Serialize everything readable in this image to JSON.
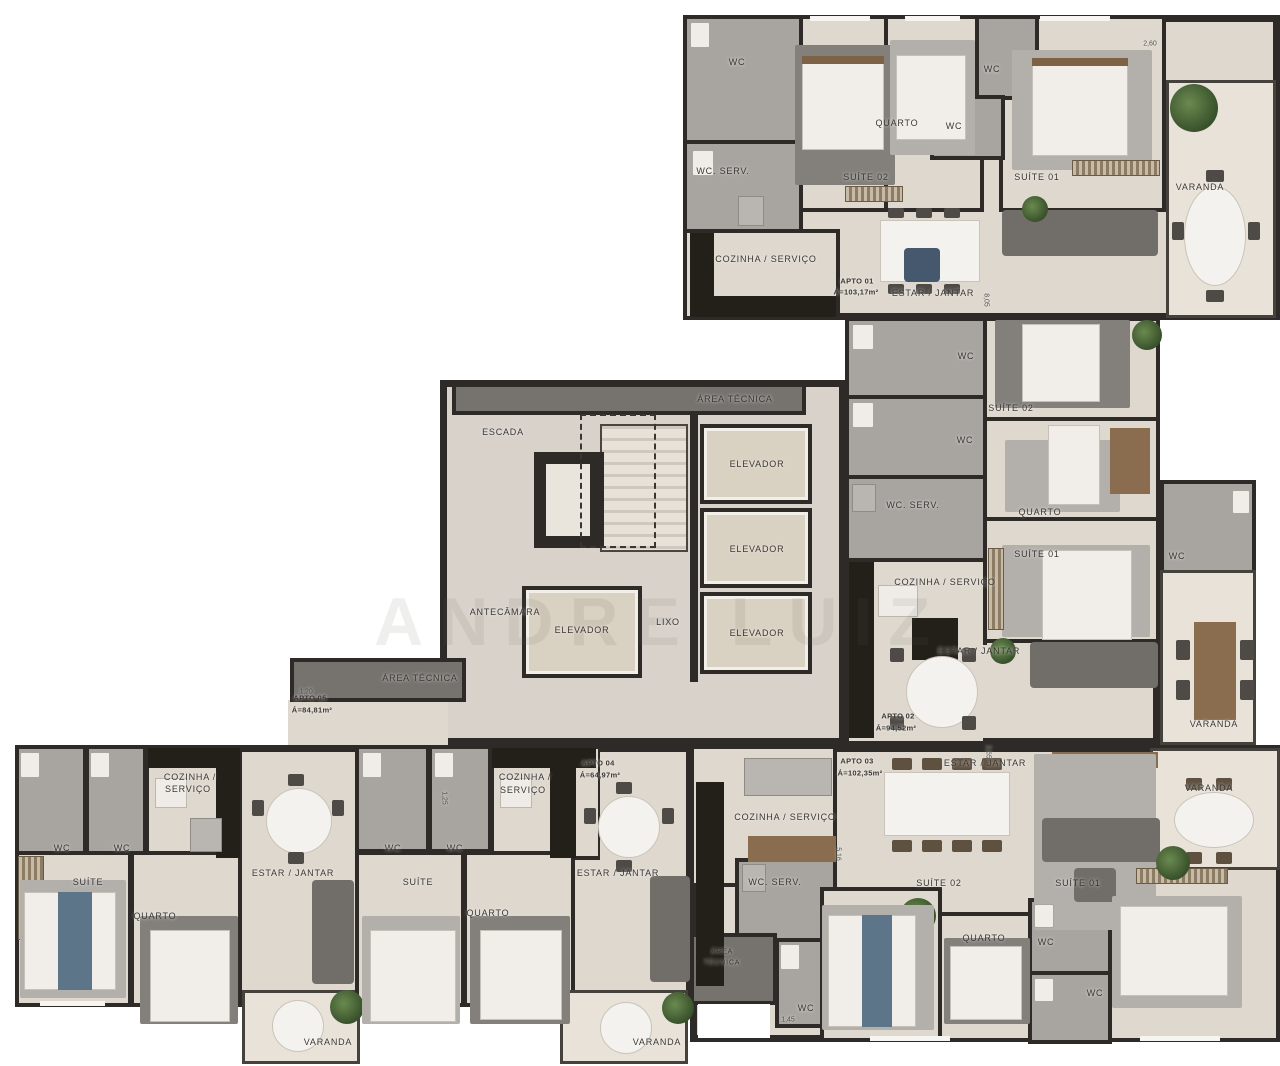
{
  "watermark": "ANDRE LUIZ",
  "colors": {
    "wall": "#2e2a27",
    "floor": "#ded8cf",
    "bathroom": "#a8a5a1",
    "core_floor": "#d8d2cb",
    "elevator": "#d9d1c1",
    "balcony": "#e8e2d9",
    "tech_area": "#76736f",
    "label_text": "#3b3733"
  },
  "apartments": [
    {
      "name": "APTO 01",
      "area_label": "Á=103,17m²",
      "rooms": [
        "SUÍTE 01",
        "SUÍTE 02",
        "QUARTO",
        "ESTAR / JANTAR",
        "COZINHA / SERVIÇO",
        "WC",
        "WC",
        "WC",
        "WC. SERV.",
        "VARANDA"
      ]
    },
    {
      "name": "APTO 02",
      "area_label": "Á=94,52m²",
      "rooms": [
        "SUÍTE 01",
        "SUÍTE 02",
        "QUARTO",
        "ESTAR / JANTAR",
        "COZINHA / SERVIÇO",
        "WC",
        "WC",
        "WC",
        "WC. SERV.",
        "VARANDA"
      ]
    },
    {
      "name": "APTO 03",
      "area_label": "Á=102,35m²",
      "rooms": [
        "SUÍTE 01",
        "SUÍTE 02",
        "QUARTO",
        "ESTAR / JANTAR",
        "COZINHA / SERVIÇO",
        "WC",
        "WC",
        "WC",
        "WC. SERV.",
        "ÁREA TÉCNICA",
        "VARANDA"
      ]
    },
    {
      "name": "APTO 04",
      "area_label": "Á=64,97m²",
      "rooms": [
        "SUÍTE",
        "QUARTO",
        "ESTAR / JANTAR",
        "COZINHA / SERVIÇO",
        "WC",
        "WC",
        "VARANDA"
      ]
    },
    {
      "name": "APTO 05",
      "area_label": "Á=84,81m²",
      "rooms": [
        "SUÍTE",
        "QUARTO",
        "ESTAR / JANTAR",
        "COZINHA / SERVIÇO",
        "WC",
        "WC",
        "VARANDA"
      ]
    }
  ],
  "common_areas": [
    "ESCADA",
    "ANTECÂMARA",
    "LIXO",
    "ELEVADOR",
    "ELEVADOR",
    "ELEVADOR",
    "ELEVADOR",
    "ÁREA TÉCNICA",
    "ÁREA TÉCNICA",
    "ÁREA TÉCNICA"
  ],
  "labels": [
    {
      "n": "label-wc",
      "t": "WC",
      "x": 737,
      "y": 62
    },
    {
      "n": "label-quarto",
      "t": "QUARTO",
      "x": 897,
      "y": 123
    },
    {
      "n": "label-wc",
      "t": "WC",
      "x": 992,
      "y": 69
    },
    {
      "n": "label-wc",
      "t": "WC",
      "x": 954,
      "y": 126
    },
    {
      "n": "label-wc-serv",
      "t": "WC. SERV.",
      "x": 723,
      "y": 171
    },
    {
      "n": "label-suite-02",
      "t": "SUÍTE 02",
      "x": 866,
      "y": 177
    },
    {
      "n": "label-suite-01",
      "t": "SUÍTE 01",
      "x": 1037,
      "y": 177
    },
    {
      "n": "label-varanda",
      "t": "VARANDA",
      "x": 1200,
      "y": 187
    },
    {
      "n": "label-cozinha-servico",
      "t": "COZINHA / SERVIÇO",
      "x": 766,
      "y": 259
    },
    {
      "n": "label-apto-01",
      "t": "APTO 01",
      "x": 857,
      "y": 281,
      "b": 1
    },
    {
      "n": "label-apto-01-area",
      "t": "Á=103,17m²",
      "x": 856,
      "y": 292,
      "b": 1
    },
    {
      "n": "label-estar-jantar",
      "t": "ESTAR / JANTAR",
      "x": 933,
      "y": 293
    },
    {
      "n": "label-area-tecnica",
      "t": "ÁREA TÉCNICA",
      "x": 735,
      "y": 399
    },
    {
      "n": "label-escada",
      "t": "ESCADA",
      "x": 503,
      "y": 432
    },
    {
      "n": "label-elevador",
      "t": "ELEVADOR",
      "x": 757,
      "y": 464
    },
    {
      "n": "label-elevador",
      "t": "ELEVADOR",
      "x": 757,
      "y": 549
    },
    {
      "n": "label-elevador",
      "t": "ELEVADOR",
      "x": 757,
      "y": 633
    },
    {
      "n": "label-elevador",
      "t": "ELEVADOR",
      "x": 582,
      "y": 630
    },
    {
      "n": "label-antecamara",
      "t": "ANTECÂMARA",
      "x": 505,
      "y": 612
    },
    {
      "n": "label-lixo",
      "t": "LIXO",
      "x": 668,
      "y": 622
    },
    {
      "n": "label-area-tecnica",
      "t": "ÁREA TÉCNICA",
      "x": 420,
      "y": 678
    },
    {
      "n": "label-wc",
      "t": "WC",
      "x": 966,
      "y": 356
    },
    {
      "n": "label-wc",
      "t": "WC",
      "x": 965,
      "y": 440
    },
    {
      "n": "label-wc-serv",
      "t": "WC. SERV.",
      "x": 913,
      "y": 505
    },
    {
      "n": "label-suite-02",
      "t": "SUÍTE 02",
      "x": 1011,
      "y": 408
    },
    {
      "n": "label-quarto",
      "t": "QUARTO",
      "x": 1040,
      "y": 512
    },
    {
      "n": "label-suite-01",
      "t": "SUÍTE 01",
      "x": 1037,
      "y": 554
    },
    {
      "n": "label-cozinha-servico",
      "t": "COZINHA / SERVIÇO",
      "x": 945,
      "y": 582
    },
    {
      "n": "label-wc",
      "t": "WC",
      "x": 1177,
      "y": 556
    },
    {
      "n": "label-estar-jantar",
      "t": "ESTAR / JANTAR",
      "x": 979,
      "y": 651
    },
    {
      "n": "label-apto-02",
      "t": "APTO 02",
      "x": 898,
      "y": 716,
      "b": 1
    },
    {
      "n": "label-apto-02-area",
      "t": "Á=94,52m²",
      "x": 896,
      "y": 728,
      "b": 1
    },
    {
      "n": "label-varanda",
      "t": "VARANDA",
      "x": 1214,
      "y": 724
    },
    {
      "n": "label-apto-05",
      "t": "APTO 05",
      "x": 310,
      "y": 698,
      "b": 1
    },
    {
      "n": "label-apto-05-area",
      "t": "Á=84,81m²",
      "x": 312,
      "y": 710,
      "b": 1
    },
    {
      "n": "label-cozinha",
      "t": "COZINHA /",
      "x": 190,
      "y": 777
    },
    {
      "n": "label-servico",
      "t": "SERVIÇO",
      "x": 188,
      "y": 789
    },
    {
      "n": "label-wc",
      "t": "WC",
      "x": 62,
      "y": 848
    },
    {
      "n": "label-wc",
      "t": "WC",
      "x": 122,
      "y": 848
    },
    {
      "n": "label-suite",
      "t": "SUÍTE",
      "x": 88,
      "y": 882
    },
    {
      "n": "label-quarto",
      "t": "QUARTO",
      "x": 155,
      "y": 916
    },
    {
      "n": "label-estar-jantar",
      "t": "ESTAR / JANTAR",
      "x": 293,
      "y": 873
    },
    {
      "n": "label-varanda",
      "t": "VARANDA",
      "x": 328,
      "y": 1042
    },
    {
      "n": "label-apto-04",
      "t": "APTO 04",
      "x": 598,
      "y": 763,
      "b": 1
    },
    {
      "n": "label-apto-04-area",
      "t": "Á=64,97m²",
      "x": 600,
      "y": 775,
      "b": 1
    },
    {
      "n": "label-cozinha",
      "t": "COZINHA /",
      "x": 525,
      "y": 777
    },
    {
      "n": "label-servico",
      "t": "SERVIÇO",
      "x": 523,
      "y": 790
    },
    {
      "n": "label-wc",
      "t": "WC",
      "x": 393,
      "y": 848
    },
    {
      "n": "label-wc",
      "t": "WC",
      "x": 455,
      "y": 848
    },
    {
      "n": "label-suite",
      "t": "SUÍTE",
      "x": 418,
      "y": 882
    },
    {
      "n": "label-quarto",
      "t": "QUARTO",
      "x": 488,
      "y": 913
    },
    {
      "n": "label-estar-jantar",
      "t": "ESTAR / JANTAR",
      "x": 618,
      "y": 873
    },
    {
      "n": "label-varanda",
      "t": "VARANDA",
      "x": 657,
      "y": 1042
    },
    {
      "n": "label-apto-03",
      "t": "APTO 03",
      "x": 857,
      "y": 761,
      "b": 1
    },
    {
      "n": "label-apto-03-area",
      "t": "Á=102,35m²",
      "x": 860,
      "y": 773,
      "b": 1
    },
    {
      "n": "label-estar-jantar",
      "t": "ESTAR / JANTAR",
      "x": 985,
      "y": 763
    },
    {
      "n": "label-cozinha-servico",
      "t": "COZINHA / SERVIÇO",
      "x": 785,
      "y": 817
    },
    {
      "n": "label-wc-serv",
      "t": "WC. SERV.",
      "x": 775,
      "y": 882
    },
    {
      "n": "label-suite-02",
      "t": "SUÍTE 02",
      "x": 939,
      "y": 883
    },
    {
      "n": "label-suite-01",
      "t": "SUÍTE 01",
      "x": 1078,
      "y": 883
    },
    {
      "n": "label-quarto",
      "t": "QUARTO",
      "x": 984,
      "y": 938
    },
    {
      "n": "label-wc",
      "t": "WC",
      "x": 1046,
      "y": 942
    },
    {
      "n": "label-wc",
      "t": "WC",
      "x": 1095,
      "y": 993
    },
    {
      "n": "label-wc",
      "t": "WC",
      "x": 806,
      "y": 1008
    },
    {
      "n": "label-area",
      "t": "ÁREA",
      "x": 722,
      "y": 952,
      "s": 7
    },
    {
      "n": "label-tecnica",
      "t": "TÉCNICA",
      "x": 722,
      "y": 963,
      "s": 7
    },
    {
      "n": "label-varanda",
      "t": "VARANDA",
      "x": 1209,
      "y": 788
    },
    {
      "n": "dim-label",
      "t": "2,60",
      "x": 1150,
      "y": 44,
      "d": 1
    },
    {
      "n": "dim-label",
      "t": "8,05",
      "x": 986,
      "y": 300,
      "d": 1,
      "r": 90
    },
    {
      "n": "dim-label",
      "t": "1,20",
      "x": 306,
      "y": 692,
      "d": 1
    },
    {
      "n": "dim-label",
      "t": "1,25",
      "x": 444,
      "y": 798,
      "d": 1,
      "r": 90
    },
    {
      "n": "dim-label",
      "t": "2,65",
      "x": 988,
      "y": 752,
      "d": 1,
      "r": 90
    },
    {
      "n": "dim-label",
      "t": "5,16",
      "x": 838,
      "y": 854,
      "d": 1,
      "r": 90
    },
    {
      "n": "dim-label",
      "t": "1,45",
      "x": 788,
      "y": 1020,
      "d": 1
    }
  ]
}
